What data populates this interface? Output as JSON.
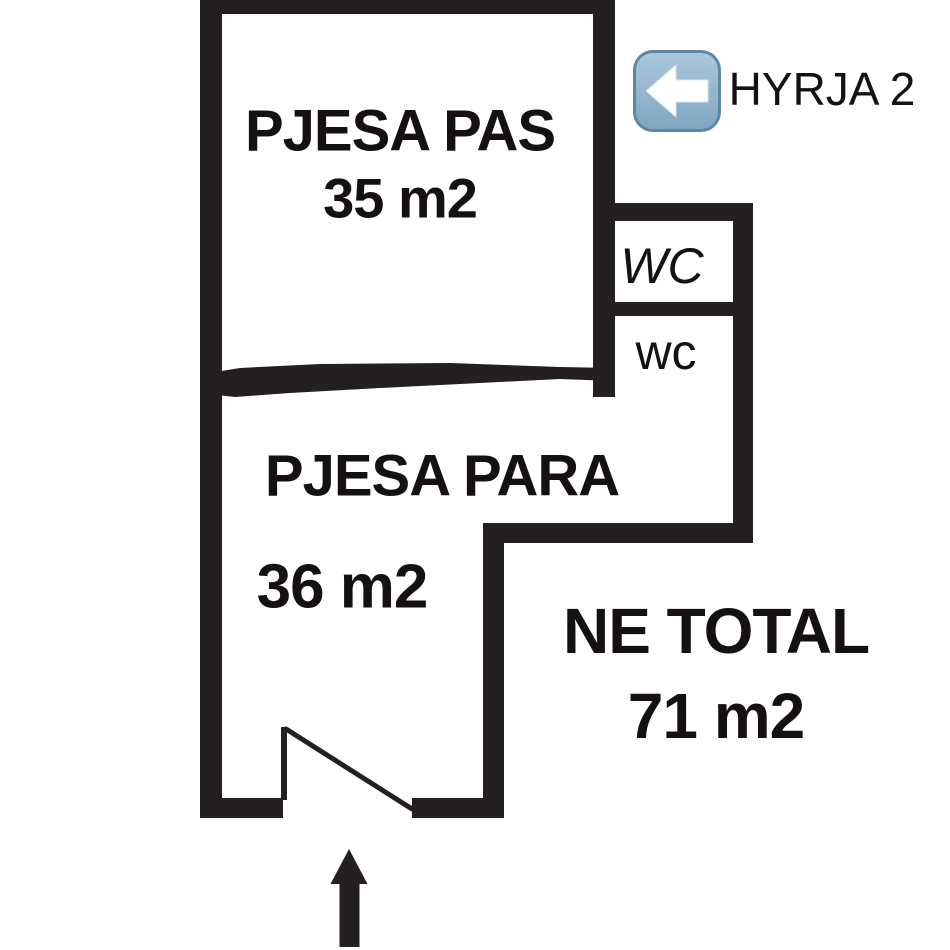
{
  "plan": {
    "room_back": {
      "name": "PJESA PAS",
      "area": "35 m2"
    },
    "room_front": {
      "name": "PJESA PARA",
      "area": "36 m2"
    },
    "wc_upper": {
      "label": "WC"
    },
    "wc_lower": {
      "label": "wc"
    },
    "total": {
      "title": "NE TOTAL",
      "area": "71 m2"
    },
    "entrance": {
      "label": "HYRJA 2",
      "icon": "left-arrow-emoji"
    },
    "door": {
      "type": "door-swing-bottom"
    },
    "entry_arrow": {
      "direction": "up"
    }
  },
  "colors": {
    "wall": "#241f21",
    "background": "#ffffff",
    "text": "#151112",
    "emoji_border": "#5f87a4",
    "emoji_fill_top": "#abc8dc",
    "emoji_fill_bottom": "#7fa5c0",
    "emoji_arrow": "#ffffff"
  }
}
